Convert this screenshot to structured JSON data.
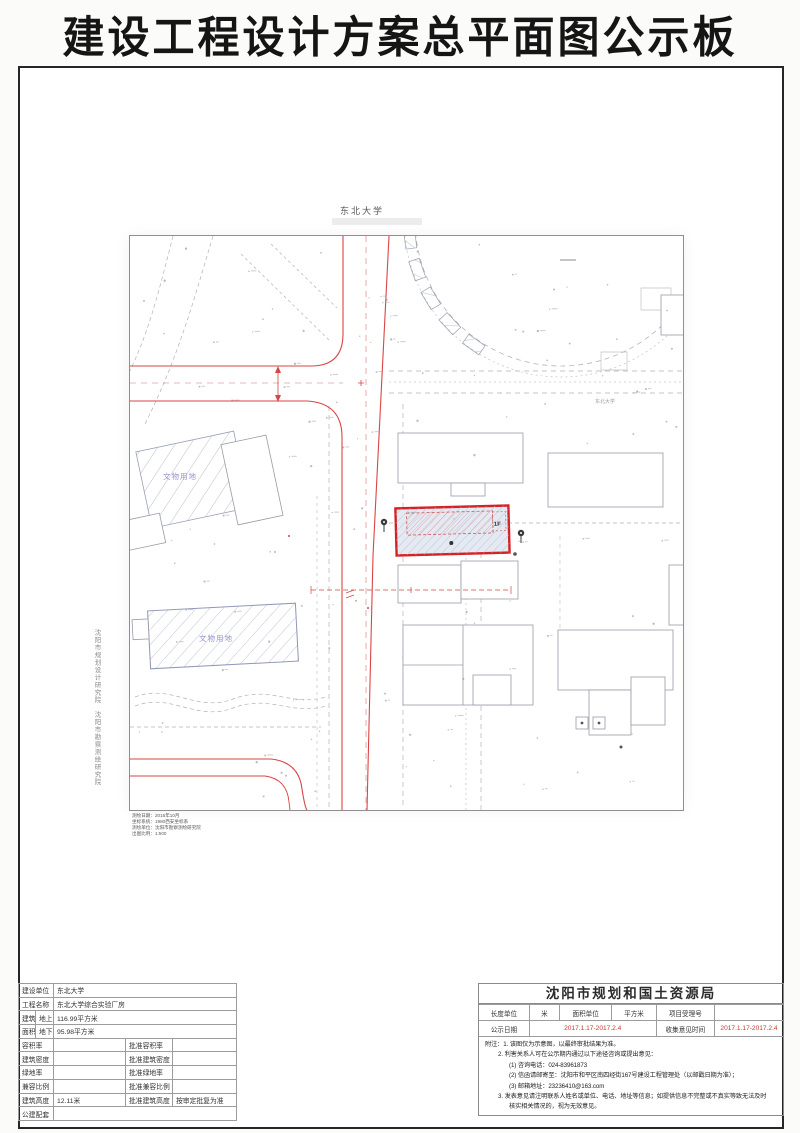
{
  "title": "建设工程设计方案总平面图公示板",
  "colors": {
    "red_line": "#d94545",
    "parcel_red": "#d42222",
    "heritage_blue": "#9793cf",
    "highlight_red": "#c43c2e"
  },
  "map": {
    "campus_label": "东北大学",
    "campus_label_small": "东北大学",
    "site_floor_label": "1F",
    "heritage_label_1": "文物用地",
    "heritage_label_2": "文物用地",
    "side_credit_1": "沈阳市规划设计研究院",
    "side_credit_2": "沈阳市勘察测绘研究院",
    "meta_line_1": "测绘日期：2016年10月",
    "meta_line_2": "坐标系统：1980西安坐标系",
    "meta_line_3": "测绘单位：沈阳市勘察测绘研究院",
    "meta_line_4": "出图比例：1:500"
  },
  "left_table": {
    "unit_label": "建设单位",
    "unit_value": "东北大学",
    "project_label": "工程名称",
    "project_value": "东北大学综合实验厂房",
    "area_label_top": "建筑",
    "area_label_bottom": "面积",
    "above_label": "地上",
    "above_value": "116.99平方米",
    "below_label": "地下",
    "below_value": "95.98平方米",
    "far_label": "容积率",
    "far_value": "",
    "far_approved_label": "批准容积率",
    "far_approved_value": "",
    "density_label": "建筑密度",
    "density_value": "",
    "density_approved_label": "批准建筑密度",
    "density_approved_value": "",
    "green_label": "绿地率",
    "green_value": "",
    "green_approved_label": "批准绿地率",
    "green_approved_value": "",
    "mix_label": "兼容比例",
    "mix_value": "",
    "mix_approved_label": "批准兼容比例",
    "mix_approved_value": "",
    "height_label": "建筑高度",
    "height_value": "12.11米",
    "height_approved_label": "批准建筑高度",
    "height_approved_value": "按审定批复为准",
    "public_label": "公建配套",
    "public_value": ""
  },
  "agency": {
    "name": "沈阳市规划和国土资源局",
    "length_unit_label": "长度单位",
    "length_unit_value": "米",
    "area_unit_label": "面积单位",
    "area_unit_value": "平方米",
    "case_label": "项目受理号",
    "case_value": "",
    "publicity_label": "公示日期",
    "publicity_value": "2017.1.17-2017.2.4",
    "collect_label": "收集意见时间",
    "collect_value": "2017.1.17-2017.2.4",
    "notes": [
      "附注：1. 该图仅为示意图，以最终审批结果为准。",
      "2. 利害关系人可在公示期内通过以下途径咨询或提出意见：",
      "(1) 咨询电话：024-83961873",
      "(2) 信函请邮寄至：沈阳市和平区南四经街167号建设工程管理处（以邮戳日期为准）；",
      "(3) 邮箱地址：23236410@163.com",
      "3. 发表意见请注明联系人姓名或单位、电话、地址等信息；如提供信息不完整或不真实等致无法及时",
      "核实相关情况的，视为无效意见。"
    ]
  }
}
